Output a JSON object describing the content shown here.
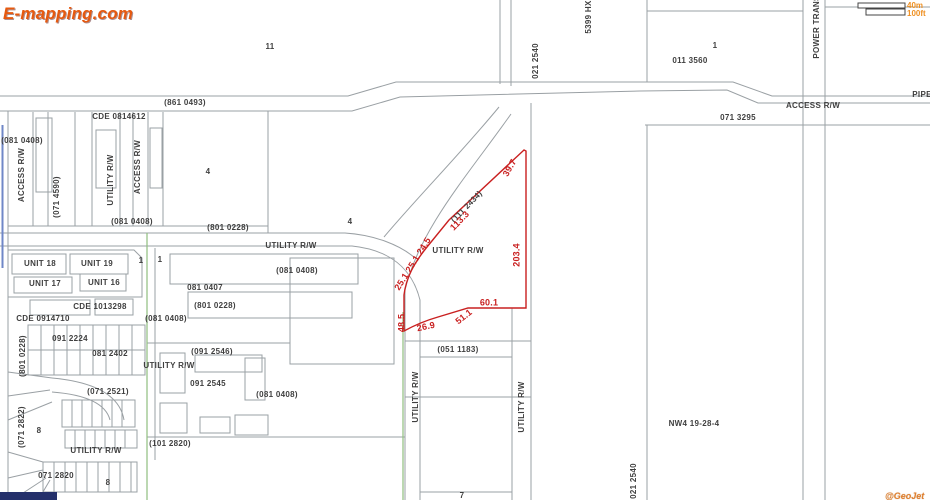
{
  "app": {
    "logo_text": "E-mapping.com",
    "watermark_text": "@GeoJet"
  },
  "scale_bar": {
    "metric_label": "40m",
    "imperial_label": "100ft"
  },
  "map": {
    "colors": {
      "highlight": "#c92020",
      "green": "#8fbf7f",
      "blue": "#6f87c7",
      "orange": "#ef9022",
      "logo": "#e6590f",
      "navy": "#24306b"
    },
    "section_label": "NW4 19-28-4",
    "labels": [
      {
        "t": "11",
        "x": 270,
        "y": 47
      },
      {
        "t": "(861 0493)",
        "x": 185,
        "y": 103
      },
      {
        "t": "CDE 0814612",
        "x": 119,
        "y": 117
      },
      {
        "t": "(081 0408)",
        "x": 22,
        "y": 141
      },
      {
        "t": "ACCESS R/W",
        "x": 22,
        "y": 175,
        "r": -90
      },
      {
        "t": "(071 4590)",
        "x": 57,
        "y": 197,
        "r": -90
      },
      {
        "t": "UTILITY R/W",
        "x": 111,
        "y": 180,
        "r": -90
      },
      {
        "t": "ACCESS R/W",
        "x": 138,
        "y": 167,
        "r": -90
      },
      {
        "t": "(081 0408)",
        "x": 132,
        "y": 222
      },
      {
        "t": "4",
        "x": 208,
        "y": 172
      },
      {
        "t": "(801 0228)",
        "x": 228,
        "y": 228
      },
      {
        "t": "4",
        "x": 350,
        "y": 222
      },
      {
        "t": "UTILITY R/W",
        "x": 291,
        "y": 246
      },
      {
        "t": "(081 0408)",
        "x": 297,
        "y": 271
      },
      {
        "t": "1",
        "x": 141,
        "y": 261
      },
      {
        "t": "1",
        "x": 160,
        "y": 260
      },
      {
        "t": "081 0407",
        "x": 205,
        "y": 288
      },
      {
        "t": "(801 0228)",
        "x": 215,
        "y": 306
      },
      {
        "t": "(081 0408)",
        "x": 166,
        "y": 319
      },
      {
        "t": "UNIT 18",
        "x": 40,
        "y": 264
      },
      {
        "t": "UNIT 19",
        "x": 97,
        "y": 264
      },
      {
        "t": "UNIT 17",
        "x": 45,
        "y": 284
      },
      {
        "t": "UNIT 16",
        "x": 104,
        "y": 283
      },
      {
        "t": "CDE 1013298",
        "x": 100,
        "y": 307
      },
      {
        "t": "CDE 0914710",
        "x": 43,
        "y": 319
      },
      {
        "t": "091 2224",
        "x": 70,
        "y": 339
      },
      {
        "t": "081 2402",
        "x": 110,
        "y": 354
      },
      {
        "t": "(801 0228)",
        "x": 23,
        "y": 356,
        "r": -90
      },
      {
        "t": "(071 2521)",
        "x": 108,
        "y": 392
      },
      {
        "t": "(071 2822)",
        "x": 22,
        "y": 427,
        "r": -90
      },
      {
        "t": "8",
        "x": 39,
        "y": 431
      },
      {
        "t": "UTILITY R/W",
        "x": 96,
        "y": 451
      },
      {
        "t": "071 2820",
        "x": 56,
        "y": 476
      },
      {
        "t": "8",
        "x": 108,
        "y": 483
      },
      {
        "t": "(091 2546)",
        "x": 212,
        "y": 352
      },
      {
        "t": "UTILITY R/W",
        "x": 169,
        "y": 366
      },
      {
        "t": "091 2545",
        "x": 208,
        "y": 384
      },
      {
        "t": "(081 0408)",
        "x": 277,
        "y": 395
      },
      {
        "t": "(101 2820)",
        "x": 170,
        "y": 444
      },
      {
        "t": "(051 1183)",
        "x": 458,
        "y": 350
      },
      {
        "t": "UTILITY R/W",
        "x": 416,
        "y": 397,
        "r": -90
      },
      {
        "t": "UTILITY R/W",
        "x": 522,
        "y": 407,
        "r": -90
      },
      {
        "t": "7",
        "x": 462,
        "y": 496
      },
      {
        "t": "021 2540",
        "x": 536,
        "y": 61,
        "r": -90
      },
      {
        "t": "5399 HX",
        "x": 589,
        "y": 17,
        "r": -90
      },
      {
        "t": "1",
        "x": 715,
        "y": 46
      },
      {
        "t": "011 3560",
        "x": 690,
        "y": 61
      },
      {
        "t": "POWER TRANS",
        "x": 817,
        "y": 27,
        "r": -90
      },
      {
        "t": "ACCESS R/W",
        "x": 813,
        "y": 106
      },
      {
        "t": "071 3295",
        "x": 738,
        "y": 118
      },
      {
        "t": "PIPE",
        "x": 922,
        "y": 95
      },
      {
        "t": "NW4 19-28-4",
        "x": 694,
        "y": 424
      },
      {
        "t": "021 2540",
        "x": 634,
        "y": 481,
        "r": -90
      },
      {
        "t": "(111 2434)",
        "x": 467,
        "y": 207,
        "r": -46
      },
      {
        "t": "UTILITY R/W",
        "x": 458,
        "y": 251
      },
      {
        "t": "39.7",
        "x": 510,
        "y": 168,
        "r": -60,
        "c": "red"
      },
      {
        "t": "113.3",
        "x": 460,
        "y": 221,
        "r": -46,
        "c": "red"
      },
      {
        "t": "25.1 25.1 24.5",
        "x": 413,
        "y": 264,
        "r": -58,
        "c": "red"
      },
      {
        "t": "48.5",
        "x": 402,
        "y": 323,
        "r": -90,
        "c": "red"
      },
      {
        "t": "26.9",
        "x": 426,
        "y": 327,
        "r": -12,
        "c": "red"
      },
      {
        "t": "51.1",
        "x": 464,
        "y": 317,
        "r": -38,
        "c": "red"
      },
      {
        "t": "60.1",
        "x": 489,
        "y": 303,
        "c": "red"
      },
      {
        "t": "203.4",
        "x": 517,
        "y": 255,
        "r": -90,
        "c": "red"
      }
    ]
  }
}
